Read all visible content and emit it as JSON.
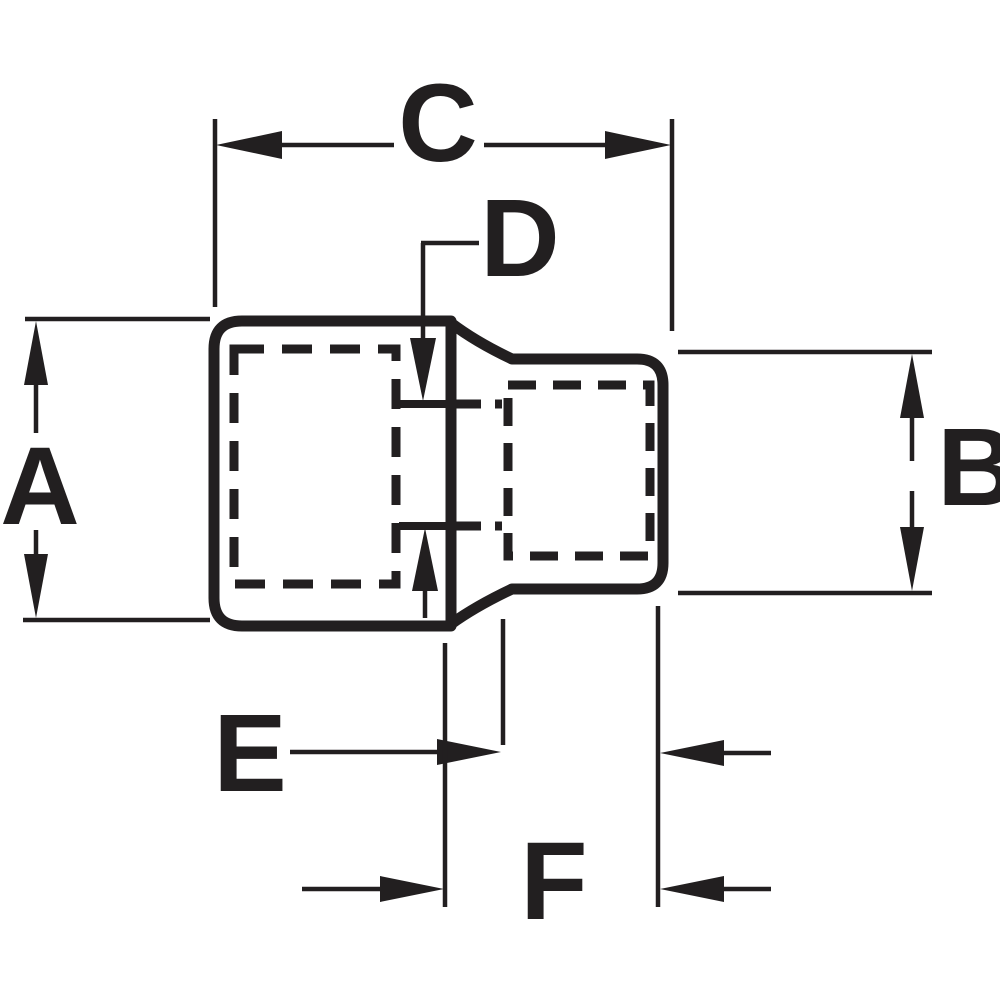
{
  "colors": {
    "ink": "#221f20",
    "paper": "#ffffff"
  },
  "drawing": {
    "kind": "dimensioned-part-diagram",
    "subject": "socket / drive adapter side profile with hidden lines and dimension arrows",
    "labels": {
      "a": "A",
      "b": "B",
      "c": "C",
      "d": "D",
      "e": "E",
      "f": "F"
    }
  }
}
